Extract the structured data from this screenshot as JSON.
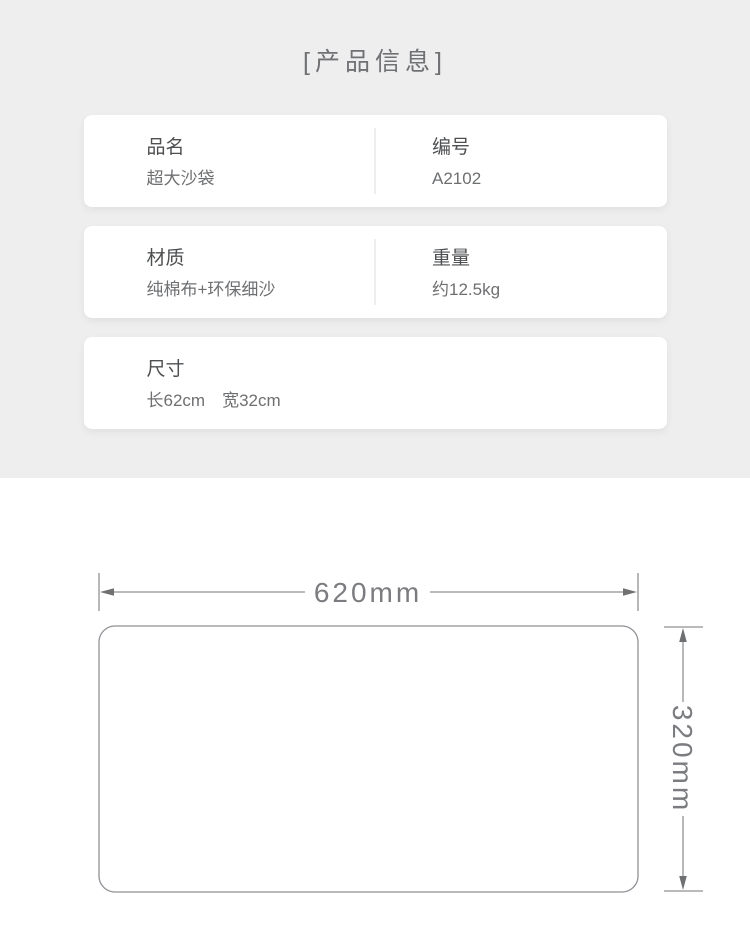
{
  "section": {
    "title": "[产品信息]"
  },
  "info_cards": [
    {
      "cells": [
        {
          "label": "品名",
          "value": "超大沙袋"
        },
        {
          "label": "编号",
          "value": "A2102"
        }
      ]
    },
    {
      "cells": [
        {
          "label": "材质",
          "value": "纯棉布+环保细沙"
        },
        {
          "label": "重量",
          "value": "约12.5kg"
        }
      ]
    },
    {
      "cells": [
        {
          "label": "尺寸",
          "value": "长62cm　宽32cm"
        }
      ]
    }
  ],
  "diagram": {
    "width_label": "620mm",
    "height_label": "320mm"
  },
  "colors": {
    "section_background": "#eeeeee",
    "card_background": "#ffffff",
    "title_text": "#707174",
    "label_text": "#4e4f51",
    "value_text": "#6e6f71",
    "diagram_line": "#909195",
    "diagram_text": "#7b7c7f"
  }
}
